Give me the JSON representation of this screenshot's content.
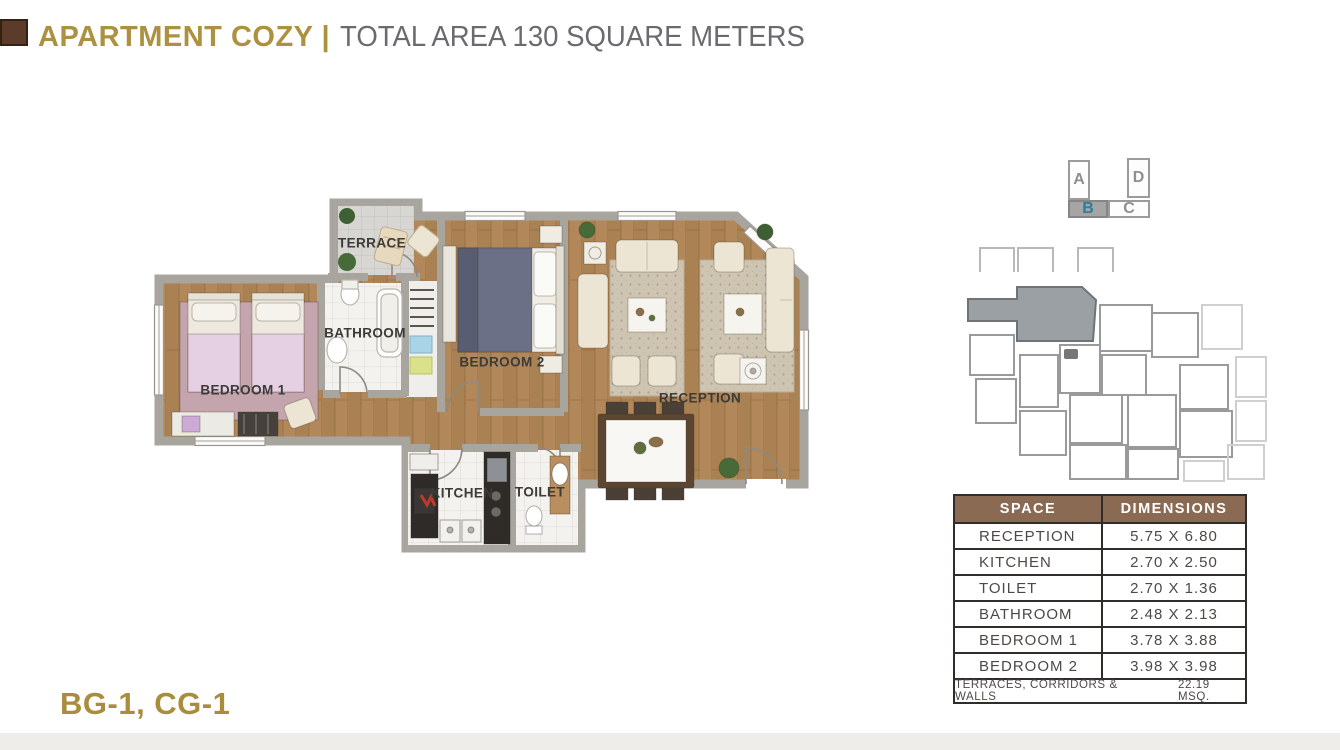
{
  "header": {
    "title": "APARTMENT COZY",
    "separator": "|",
    "subtitle": "TOTAL AREA 130 SQUARE METERS"
  },
  "floor_plan": {
    "rooms": [
      {
        "label": "TERRACE"
      },
      {
        "label": "BATHROOM"
      },
      {
        "label": "BEDROOM 1"
      },
      {
        "label": "BEDROOM 2"
      },
      {
        "label": "RECEPTION"
      },
      {
        "label": "KITCHEN"
      },
      {
        "label": "TOILET"
      }
    ]
  },
  "unit_key": {
    "units": [
      {
        "label": "A",
        "highlighted": false
      },
      {
        "label": "B",
        "highlighted": true
      },
      {
        "label": "C",
        "highlighted": false
      },
      {
        "label": "D",
        "highlighted": false
      }
    ]
  },
  "dimensions_table": {
    "headers": [
      "SPACE",
      "DIMENSIONS"
    ],
    "rows": [
      {
        "space": "RECEPTION",
        "dimensions": "5.75 X 6.80"
      },
      {
        "space": "KITCHEN",
        "dimensions": "2.70 X 2.50"
      },
      {
        "space": "TOILET",
        "dimensions": "2.70 X 1.36"
      },
      {
        "space": "BATHROOM",
        "dimensions": "2.48 X 2.13"
      },
      {
        "space": "BEDROOM 1",
        "dimensions": "3.78 X 3.88"
      },
      {
        "space": "BEDROOM 2",
        "dimensions": "3.98 X 3.98"
      }
    ],
    "footer_label": "TERRACES, CORRIDORS & WALLS",
    "footer_value": "22.19 MSQ."
  },
  "footer": {
    "unit_codes": "BG-1, CG-1"
  },
  "colors": {
    "gold": "#ac9140",
    "title_gray": "#6a6b6e",
    "accent_brown": "#5b3c2a",
    "table_header_brown": "#8a6a53",
    "unit_highlight_teal": "#2a7e99",
    "unit_highlight_gray": "#a5a5a5",
    "wood_floor": "#b2885a",
    "wall_gray": "#a8a49e"
  }
}
